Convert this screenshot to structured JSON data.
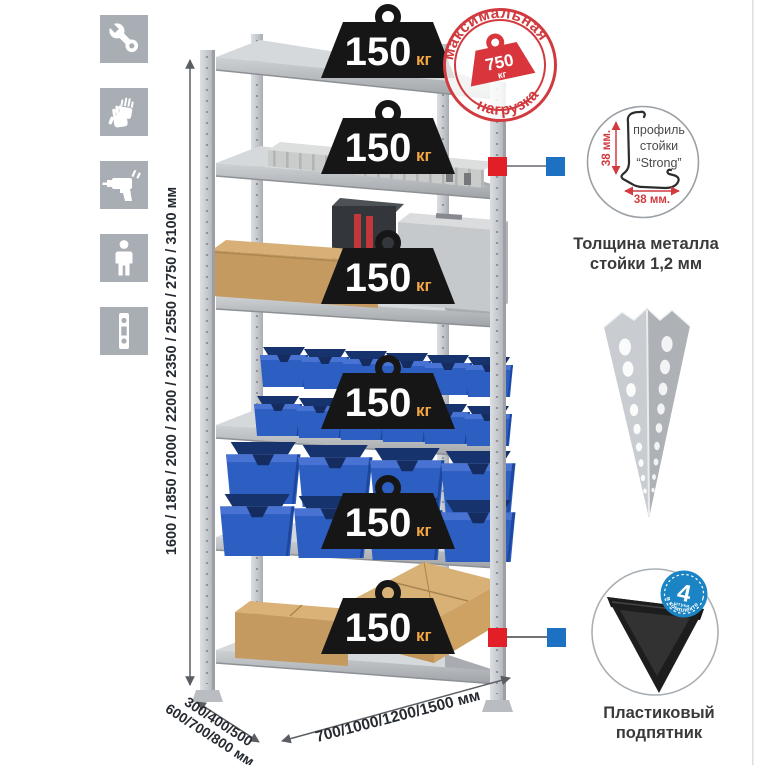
{
  "sidebar": {
    "icons": [
      {
        "name": "wrench-icon"
      },
      {
        "name": "gloves-icon"
      },
      {
        "name": "drill-icon"
      },
      {
        "name": "person-icon"
      },
      {
        "name": "rack-post-icon"
      }
    ]
  },
  "dimensions": {
    "height_label": "1600 / 1850 / 2000 / 2200 / 2350 / 2550 / 2750 / 3100 мм",
    "depth_label_line1": "300/400/500",
    "depth_label_line2": "600/700/800 мм",
    "width_label": "700/1000/1200/1500 мм"
  },
  "shelves": [
    {
      "load": "150",
      "unit": "кг",
      "contents": "empty-top-shelf"
    },
    {
      "load": "150",
      "unit": "кг",
      "contents": "aluminum-case"
    },
    {
      "load": "150",
      "unit": "кг",
      "contents": "cardboard-box-and-metal-boxes"
    },
    {
      "load": "150",
      "unit": "кг",
      "contents": "small-blue-bins"
    },
    {
      "load": "150",
      "unit": "кг",
      "contents": "large-blue-bins"
    },
    {
      "load": "150",
      "unit": "кг",
      "contents": "cardboard-boxes"
    }
  ],
  "max_load_stamp": {
    "arc_top": "максимальная",
    "arc_bottom": "нагрузка",
    "value": "750",
    "unit": "кг"
  },
  "profile_detail": {
    "label_line1": "профиль",
    "label_line2": "стойки",
    "label_line3": "“Strong”",
    "vertical_dimension": "38 мм.",
    "horizontal_dimension": "38 мм.",
    "caption_line1": "Толщина металла",
    "caption_line2": "стойки 1,2 мм"
  },
  "foot_detail": {
    "badge_number": "4",
    "badge_small": "штуки",
    "badge_arc": "в комплекте",
    "caption_line1": "Пластиковый",
    "caption_line2": "подпятник"
  },
  "colors": {
    "accent_red": "#d13b40",
    "accent_blue": "#1d71c2",
    "bin_blue": "#2d5ec2",
    "kg_orange": "#f2a544"
  }
}
